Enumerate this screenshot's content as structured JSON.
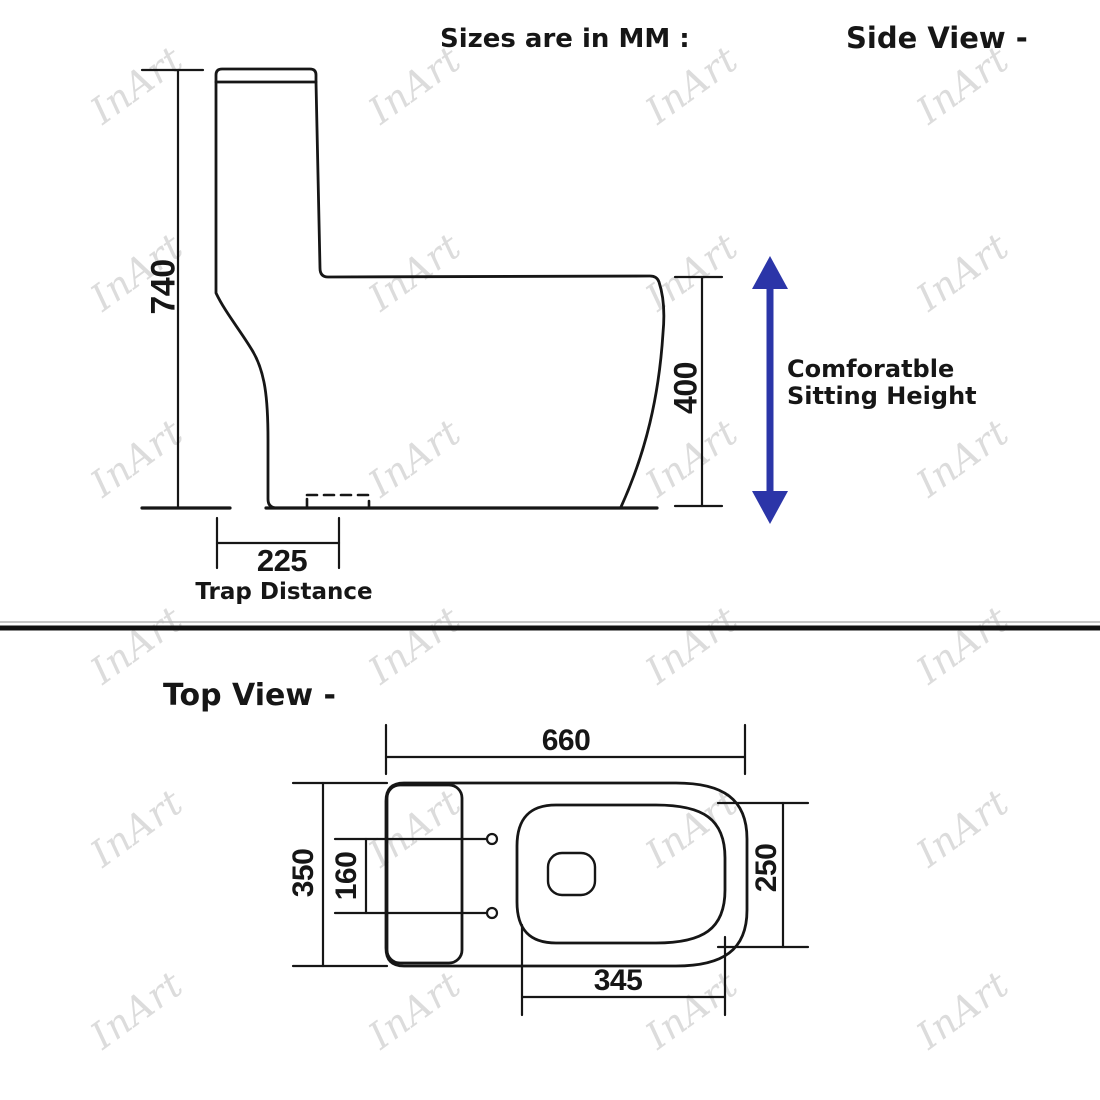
{
  "titles": {
    "sizes_note": "Sizes are in MM :",
    "side_view": "Side View -",
    "top_view": "Top View -"
  },
  "side_view": {
    "dims": {
      "overall_height": "740",
      "sitting_height": "400",
      "trap_distance": "225"
    },
    "labels": {
      "trap": "Trap Distance",
      "comfort_line1": "Comforatble",
      "comfort_line2": "Sitting Height"
    },
    "arrow_color": "#2b35a8"
  },
  "top_view": {
    "dims": {
      "overall_length": "660",
      "overall_width": "350",
      "bolt_hole_spacing": "160",
      "seat_width": "250",
      "seat_length": "345"
    }
  },
  "line_color": "#161616",
  "watermark": {
    "text": "InArt",
    "color": "#dcdcdc",
    "positions": [
      {
        "x": 137,
        "y": 85
      },
      {
        "x": 415,
        "y": 85
      },
      {
        "x": 692,
        "y": 85
      },
      {
        "x": 963,
        "y": 85
      },
      {
        "x": 137,
        "y": 272
      },
      {
        "x": 415,
        "y": 272
      },
      {
        "x": 692,
        "y": 272
      },
      {
        "x": 963,
        "y": 272
      },
      {
        "x": 137,
        "y": 458
      },
      {
        "x": 415,
        "y": 458
      },
      {
        "x": 692,
        "y": 458
      },
      {
        "x": 963,
        "y": 458
      },
      {
        "x": 137,
        "y": 645
      },
      {
        "x": 415,
        "y": 645
      },
      {
        "x": 692,
        "y": 645
      },
      {
        "x": 963,
        "y": 645
      },
      {
        "x": 137,
        "y": 828
      },
      {
        "x": 415,
        "y": 828
      },
      {
        "x": 692,
        "y": 828
      },
      {
        "x": 963,
        "y": 828
      },
      {
        "x": 137,
        "y": 1010
      },
      {
        "x": 415,
        "y": 1010
      },
      {
        "x": 692,
        "y": 1010
      },
      {
        "x": 963,
        "y": 1010
      }
    ]
  }
}
